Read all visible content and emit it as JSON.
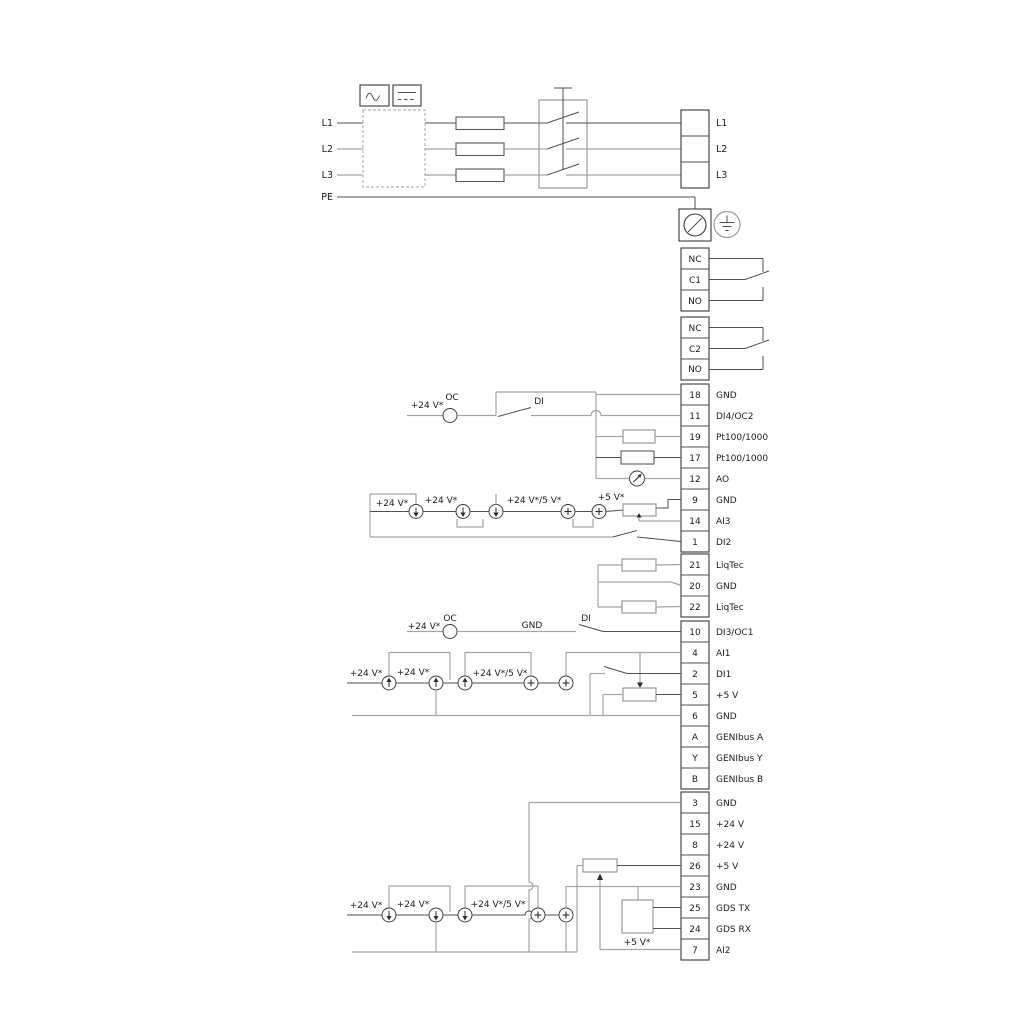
{
  "power": {
    "inputs": [
      "L1",
      "L2",
      "L3",
      "PE"
    ],
    "outputs": [
      "L1",
      "L2",
      "L3"
    ]
  },
  "relays": {
    "r1": [
      "NC",
      "C1",
      "NO"
    ],
    "r2": [
      "NC",
      "C2",
      "NO"
    ]
  },
  "blocks": {
    "io1": [
      {
        "num": "18",
        "label": "GND"
      },
      {
        "num": "11",
        "label": "DI4/OC2"
      },
      {
        "num": "19",
        "label": "Pt100/1000"
      },
      {
        "num": "17",
        "label": "Pt100/1000"
      },
      {
        "num": "12",
        "label": "AO"
      },
      {
        "num": "9",
        "label": "GND"
      },
      {
        "num": "14",
        "label": "AI3"
      },
      {
        "num": "1",
        "label": "DI2"
      }
    ],
    "liqtec": [
      {
        "num": "21",
        "label": "LiqTec"
      },
      {
        "num": "20",
        "label": "GND"
      },
      {
        "num": "22",
        "label": "LiqTec"
      }
    ],
    "io2": [
      {
        "num": "10",
        "label": "DI3/OC1"
      },
      {
        "num": "4",
        "label": "AI1"
      },
      {
        "num": "2",
        "label": "DI1"
      },
      {
        "num": "5",
        "label": "+5 V"
      },
      {
        "num": "6",
        "label": "GND"
      },
      {
        "num": "A",
        "label": "GENIbus A"
      },
      {
        "num": "Y",
        "label": "GENIbus Y"
      },
      {
        "num": "B",
        "label": "GENIbus B"
      }
    ],
    "io3": [
      {
        "num": "3",
        "label": "GND"
      },
      {
        "num": "15",
        "label": "+24 V"
      },
      {
        "num": "8",
        "label": "+24 V"
      },
      {
        "num": "26",
        "label": "+5 V"
      },
      {
        "num": "23",
        "label": "GND"
      },
      {
        "num": "25",
        "label": "GDS TX"
      },
      {
        "num": "24",
        "label": "GDS RX"
      },
      {
        "num": "7",
        "label": "AI2"
      }
    ]
  },
  "ann": {
    "di4": {
      "v24": "+24 V*",
      "oc": "OC",
      "di": "DI"
    },
    "ai3": {
      "v24a": "+24 V*",
      "v24b": "+24 V*",
      "v245": "+24 V*/5 V*",
      "v5": "+5 V*"
    },
    "di3": {
      "v24": "+24 V*",
      "oc": "OC",
      "gnd": "GND",
      "di": "DI"
    },
    "ai1": {
      "v24a": "+24 V*",
      "v24b": "+24 V*",
      "v245": "+24 V*/5 V*"
    },
    "ai2": {
      "v24a": "+24 V*",
      "v24b": "+24 V*",
      "v245": "+24 V*/5 V*",
      "v5": "+5 V*"
    }
  },
  "colors": {
    "wire_dark": "#4f4f4f",
    "wire_gray": "#a5a5a5",
    "text": "#1d1d1d",
    "background": "#ffffff"
  }
}
